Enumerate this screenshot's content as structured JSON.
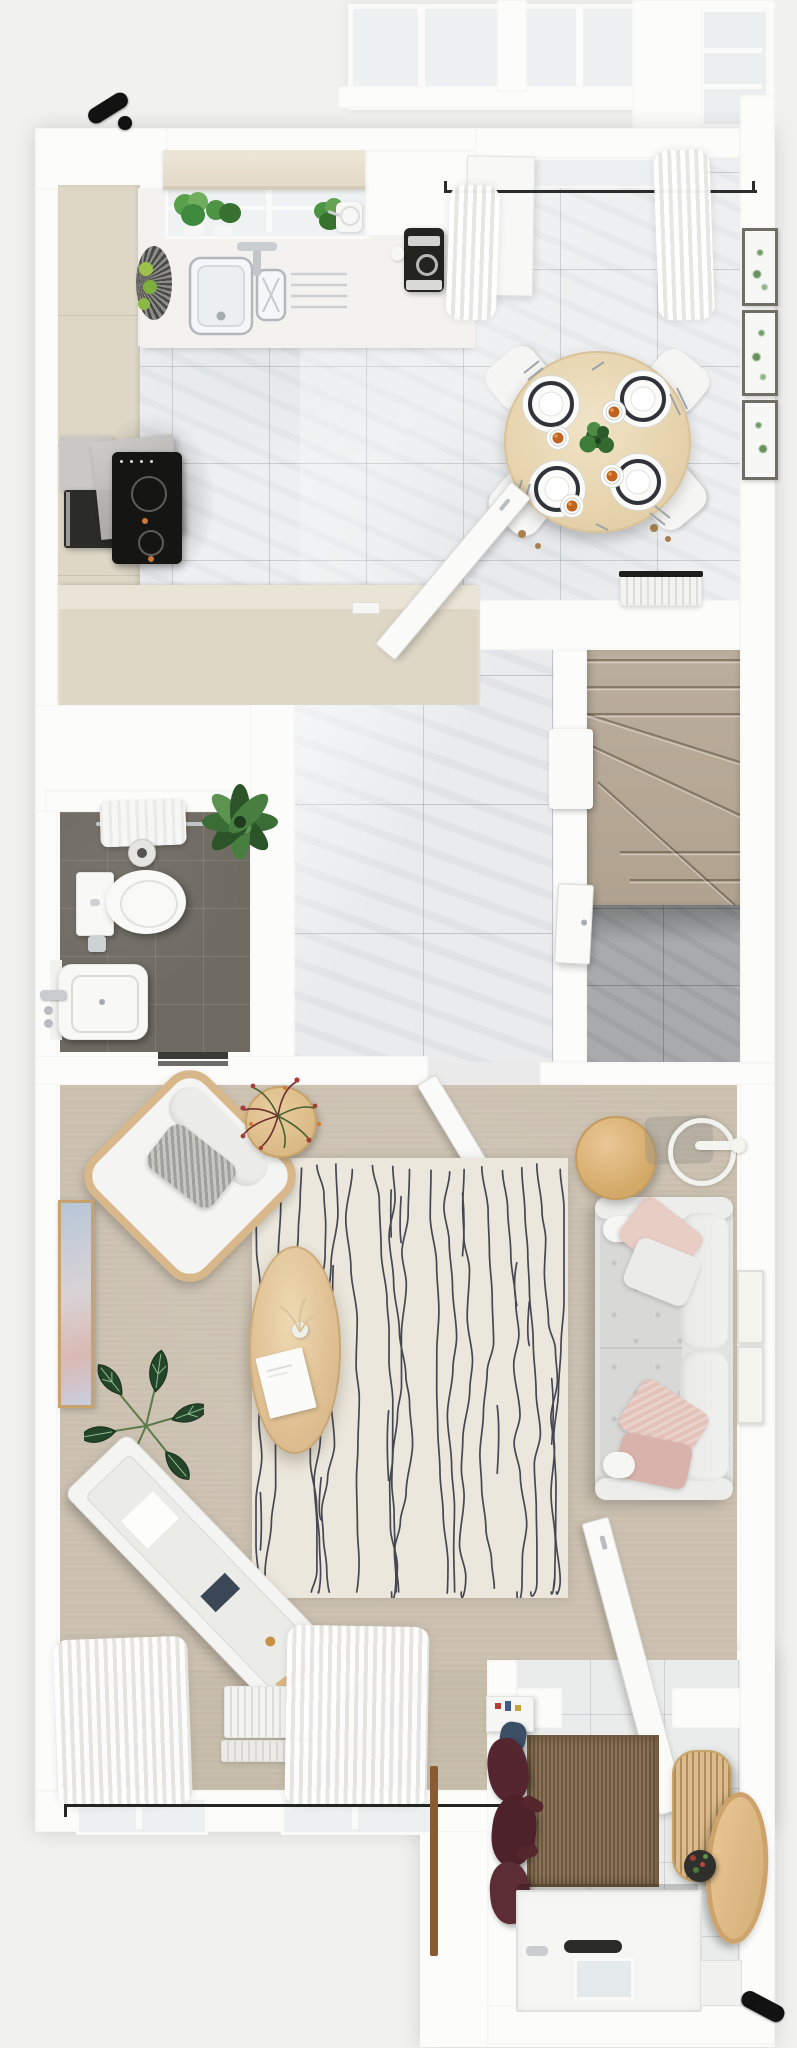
{
  "scene": {
    "kind": "top-down-3d-floor-plan-render",
    "rooms_count": 6
  },
  "palette": {
    "page_bg": "#f1f1ef",
    "wall": "#fcfcfb",
    "marble_floor": "#edeff0",
    "hall_marble": "#e9ebed",
    "closet_marble": "#a8aaab",
    "bath_tile": "#6f6b63",
    "stair_carpet": "#b5a795",
    "living_carpet": "#cabfae",
    "rug_base": "#ece7dc",
    "rug_stripe": "#2e3140",
    "cream_cabinet": "#ded7c6",
    "worktop": "#f3f2ee",
    "wood_light": "#e8d5b0",
    "wood_mid": "#ddba88",
    "sofa": "#e2e2e0",
    "pillow_pink": "#e8cdc5",
    "pillow_pink_dark": "#d9b3ab",
    "coat_burgundy": "#552630",
    "jute_rug": "#8b7458",
    "plant_green": "#3e7a39",
    "coffee_orange": "#c2641f",
    "hardware_black": "#121212"
  },
  "rooms": {
    "kitchen": {
      "name": "kitchen",
      "items": [
        "window-roman-shade",
        "herb-plant",
        "herb-plant",
        "herb-plant",
        "watering-can",
        "double-basin-sink",
        "chrome-faucet",
        "drainboard",
        "fruit-basket",
        "coffee-machine",
        "espresso-cup",
        "induction-hob",
        "extractor-hood",
        "oven",
        "u-shaped-cream-cabinets"
      ],
      "herb_plants_count": 3
    },
    "dining": {
      "name": "dining-area",
      "items": [
        "round-wood-table",
        "dining-chair",
        "place-setting",
        "coffee-cup",
        "centerpiece-plant",
        "radiator",
        "botanical-wall-frame",
        "sheer-curtain",
        "curtain-rod",
        "open-patio-door"
      ],
      "chairs_count": 4,
      "plates_count": 4,
      "cups_count": 4,
      "wall_frames_count": 3
    },
    "hallway": {
      "name": "hallway",
      "items": [
        "marble-floor",
        "open-door-to-kitchen",
        "open-door-to-living-room",
        "understairs-closet-door",
        "light-switch"
      ]
    },
    "staircase": {
      "name": "staircase",
      "items": [
        "carpeted-winder-stairs",
        "newel-post",
        "understairs-storage-floor"
      ]
    },
    "bathroom": {
      "name": "bathroom",
      "items": [
        "toilet",
        "hand-basin",
        "chrome-faucet",
        "towel-rail",
        "towel",
        "waste-bin",
        "toilet-roll-holder",
        "potted-plant",
        "dark-tile-floor",
        "door-threshold"
      ]
    },
    "living_room": {
      "name": "living-room",
      "items": [
        "armchair",
        "knit-pillow",
        "side-table-with-flowers",
        "ring-floor-lamp",
        "round-side-table",
        "three-seat-sofa",
        "sofa-pillow",
        "oval-coffee-table",
        "book",
        "vase",
        "striped-rug",
        "alocasia-plant",
        "media-sideboard",
        "wall-art",
        "relief-wall-frame",
        "radiator",
        "sheer-curtain",
        "curtain-rod",
        "window"
      ],
      "sofa_pillows_count": 5,
      "windows_count": 2,
      "relief_frames_count": 2
    },
    "entry": {
      "name": "entry-hall",
      "items": [
        "front-door",
        "letterbox",
        "door-glass-pane",
        "doormat",
        "jute-runner",
        "hanging-coats",
        "shoes",
        "console-shelf",
        "slatted-cabinet",
        "leaning-round-table",
        "plant-bowl"
      ]
    },
    "exterior": {
      "name": "exterior",
      "items": [
        "door-handle-top",
        "door-handle-bottom",
        "conservatory-glazing",
        "porch-beam"
      ]
    }
  }
}
